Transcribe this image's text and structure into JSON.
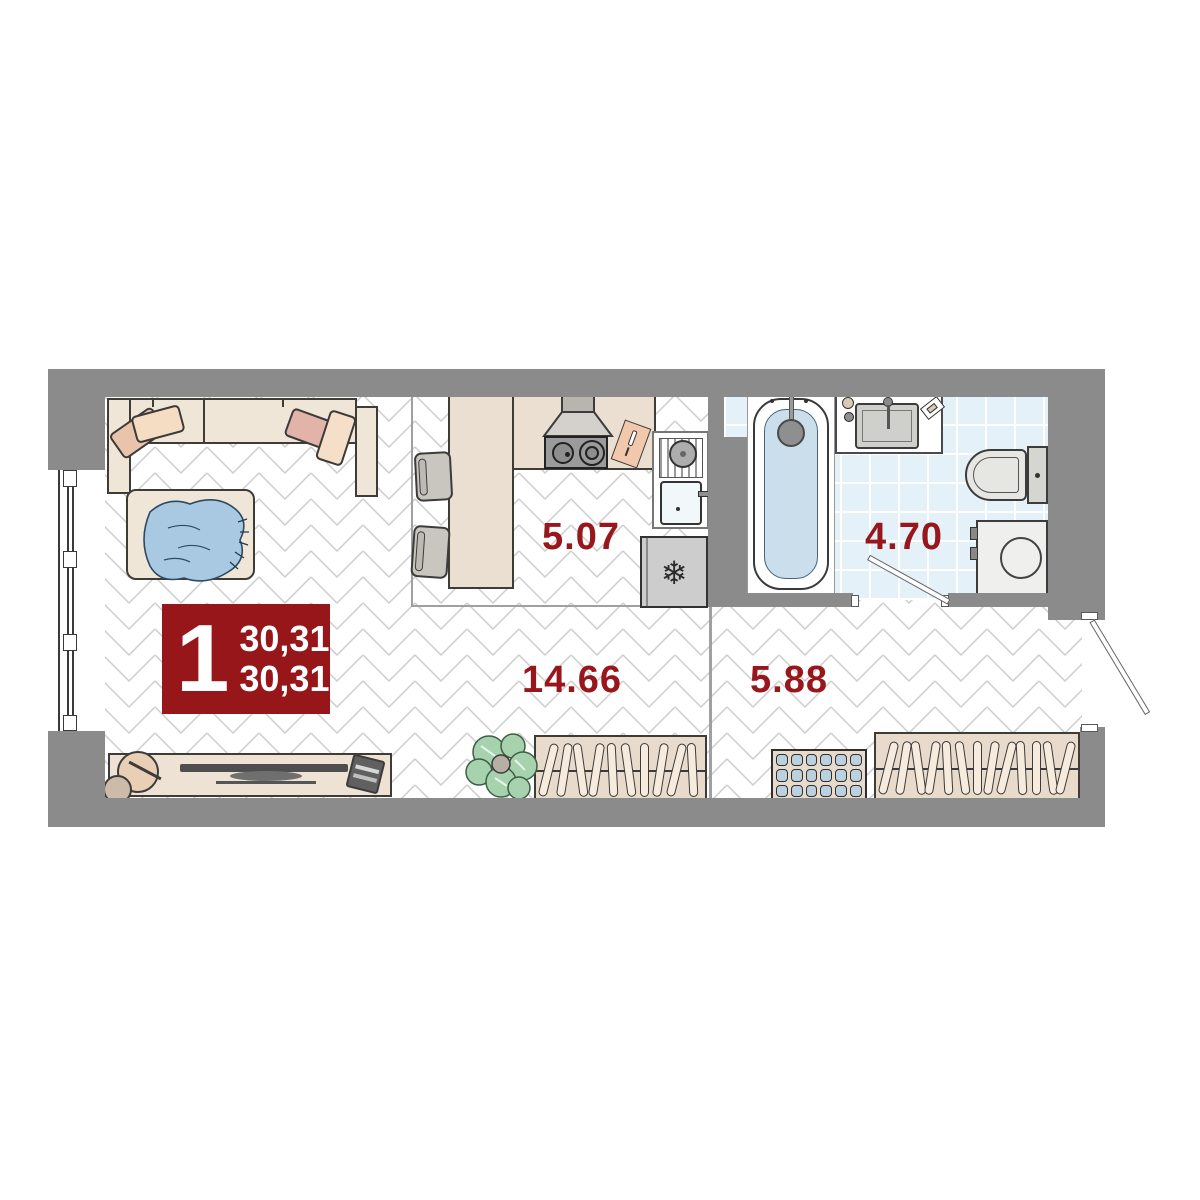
{
  "floorplan": {
    "badge": {
      "rooms_count": "1",
      "total_area": "30,31",
      "living_area": "30,31"
    },
    "room_labels": {
      "kitchen": "5.07",
      "bathroom": "4.70",
      "living_room": "14.66",
      "hallway": "5.88"
    },
    "icons": {
      "fridge_snowflake": "❄"
    },
    "colors": {
      "accent_red": "#97171C",
      "wall_gray": "#8B8B8B",
      "bathroom_tile": "#E4F1F8",
      "furniture_beige": "#F0E6D8",
      "textile_blue": "#A9C9E2"
    }
  }
}
